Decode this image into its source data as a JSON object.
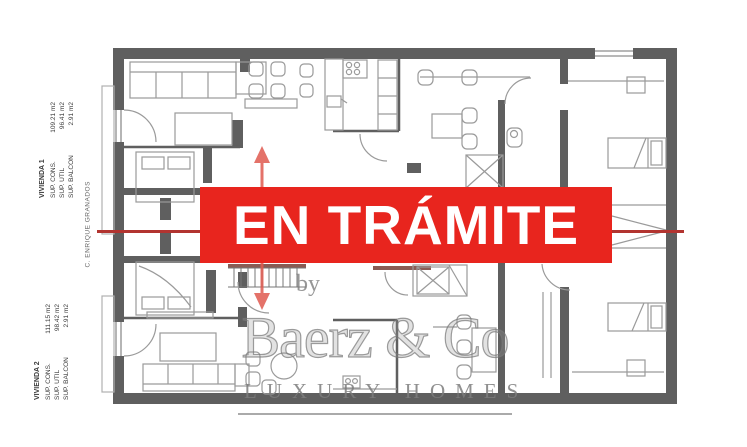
{
  "banner": {
    "label": "EN TRÁMITE",
    "background": "#e8251e",
    "text_color": "#ffffff"
  },
  "units": [
    {
      "name": "VIVIENDA 1",
      "rows": [
        {
          "label": "SUP. CONS.",
          "value": "109.21 m2"
        },
        {
          "label": "SUP. UTIL",
          "value": "96.41 m2"
        },
        {
          "label": "SUP. BALCON",
          "value": "2.91 m2"
        }
      ]
    },
    {
      "name": "VIVIENDA 2",
      "rows": [
        {
          "label": "SUP. CONS.",
          "value": "111.15 m2"
        },
        {
          "label": "SUP. UTIL",
          "value": "98.42 m2"
        },
        {
          "label": "SUP. BALCON",
          "value": "2.91 m2"
        }
      ]
    }
  ],
  "street": {
    "label": "C. ENRIQUE GRANADOS"
  },
  "watermark": {
    "by": "by",
    "brand": "Baerz & Co",
    "tagline": "LUXURY HOMES"
  },
  "colors": {
    "banner_red": "#e8251e",
    "annotation_line_red": "#b23430",
    "arrow_red": "#e05a50",
    "wall_gray": "#5f5f5f",
    "furniture_gray": "#9a9a9a",
    "watermark_gray": "#8a8a8a",
    "accent_brown": "#7d4a42"
  }
}
